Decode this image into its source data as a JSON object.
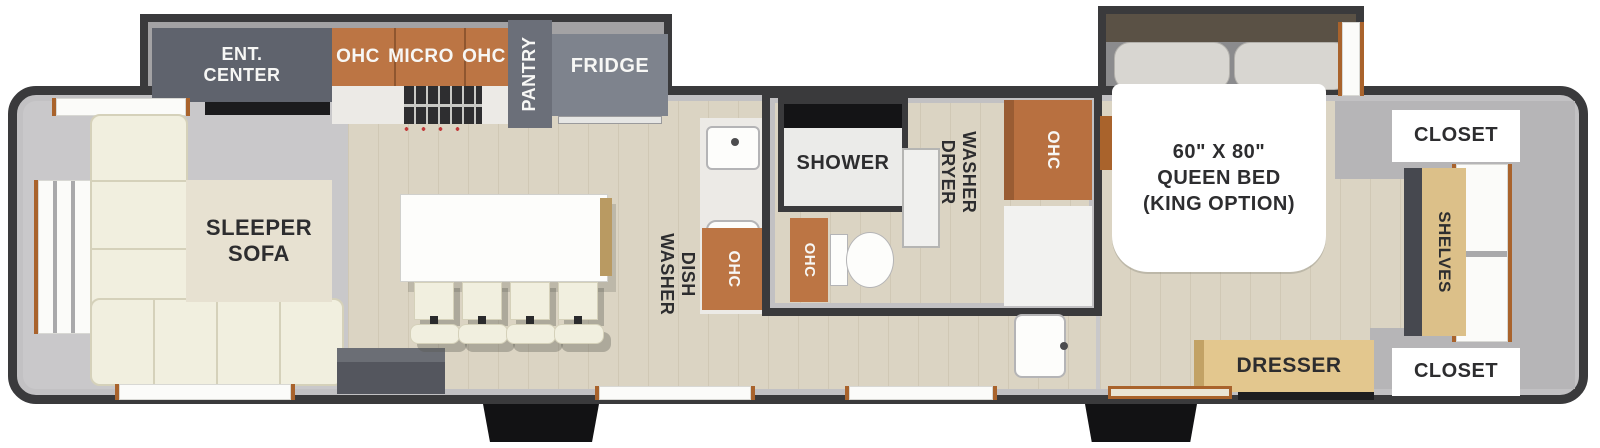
{
  "title": "Travel trailer floor plan",
  "colors": {
    "wall": "#3a3a3c",
    "wall_light": "#c2c1c3",
    "wall_light2": "#b6b5b7",
    "floor_gray": "#c9c8ca",
    "floor_wood": "#dbd4c3",
    "slide_gray": "#a3a2a4",
    "cabinet": "#bc7544",
    "cabinet_dark": "#b87040",
    "gray_box": "#5f636d",
    "fridge_gray": "#7e838d",
    "pantry_gray": "#6b6f79",
    "sofa": "#f1efdf",
    "sofa_line": "#d5d1ba",
    "tan": "#dcc089",
    "wood_trim": "#a9632c",
    "label_dark": "#2d2d2f",
    "label_light": "#f7f7f5",
    "step": "#121214",
    "headboard": "#5a5145",
    "pillow": "#d8d6d1",
    "stove_red": "#c23a3a"
  },
  "labels": {
    "ent_center": "ENT.\nCENTER",
    "ohc_left": "OHC",
    "micro": "MICRO",
    "ohc_right": "OHC",
    "pantry": "PANTRY",
    "fridge": "FRIDGE",
    "sleeper_sofa": "SLEEPER\nSOFA",
    "dish_washer": "DISH\nWASHER",
    "ohc_kitchen": "OHC",
    "shower": "SHOWER",
    "ohc_bathroom": "OHC",
    "washer_dryer": "WASHER\nDRYER",
    "ohc_vanity": "OHC",
    "queen_bed": "60\" X 80\"\nQUEEN BED\n(KING OPTION)",
    "closet_top": "CLOSET",
    "shelves": "SHELVES",
    "closet_bottom": "CLOSET",
    "dresser": "DRESSER"
  }
}
